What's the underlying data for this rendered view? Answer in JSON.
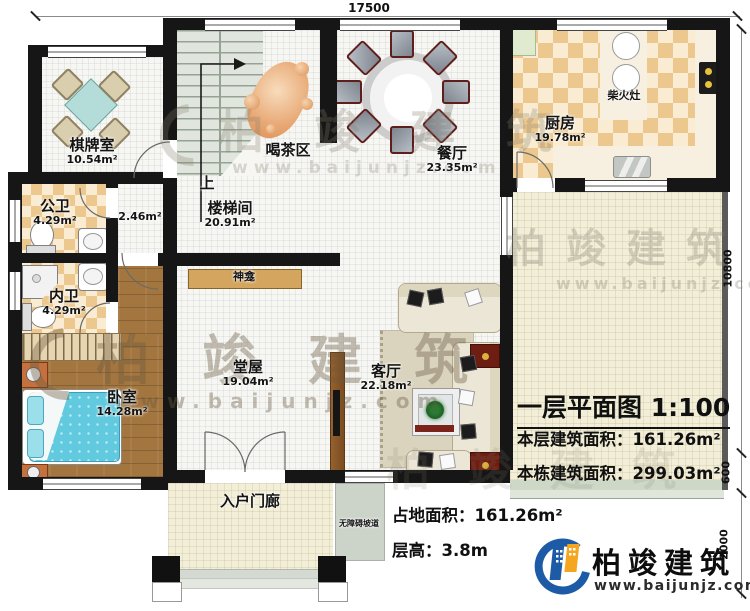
{
  "plan": {
    "title": "一层平面图",
    "scale": "1:100",
    "floor_area_label": "本层建筑面积：",
    "floor_area_value": "161.26m²",
    "building_area_label": "本栋建筑面积：",
    "building_area_value": "299.03m²",
    "land_area_label": "占地面积：",
    "land_area_value": "161.26m²",
    "height_label": "层高：",
    "height_value": "3.8m"
  },
  "dimensions": {
    "top": "17500",
    "right_upper": "10800",
    "right_mid": "600",
    "right_lower": "2000"
  },
  "rooms": {
    "chess": {
      "name": "棋牌室",
      "area": "10.54m²"
    },
    "tea": {
      "name": "喝茶区"
    },
    "dining": {
      "name": "餐厅",
      "area": "23.35m²"
    },
    "kitchen": {
      "name": "厨房",
      "area": "19.78m²"
    },
    "wood_stove": {
      "name": "柴火灶"
    },
    "public_bath": {
      "name": "公卫",
      "area": "4.29m²"
    },
    "hall_small": {
      "area": "2.46m²"
    },
    "stairwell": {
      "name": "楼梯间",
      "area": "20.91m²"
    },
    "up": {
      "name": "上"
    },
    "shrine": {
      "name": "神龛"
    },
    "inner_bath": {
      "name": "内卫",
      "area": "4.29m²"
    },
    "bedroom": {
      "name": "卧室",
      "area": "14.28m²"
    },
    "main_hall": {
      "name": "堂屋",
      "area": "19.04m²"
    },
    "living": {
      "name": "客厅",
      "area": "22.18m²"
    },
    "porch": {
      "name": "入户门廊"
    },
    "ramp": {
      "name": "无障碍坡道"
    }
  },
  "brand": {
    "name": "柏竣建筑",
    "url": "www.baijunjz.com"
  },
  "watermark": {
    "name": "柏竣建筑",
    "url": "www.baijunjz.com"
  },
  "colors": {
    "wall": "#161616",
    "tile_dark": "#ecc88e",
    "tile_light": "#f9ecd2",
    "wood_floor": "#a4763f",
    "stair": "#e0e6de",
    "courtyard": "#f2eed7",
    "bed_blue": "#62cade",
    "sofa_beige": "#ece6d6",
    "accent_red": "#6e1d12",
    "brand_blue": "#1d5ba6",
    "brand_orange": "#f5a51f"
  }
}
